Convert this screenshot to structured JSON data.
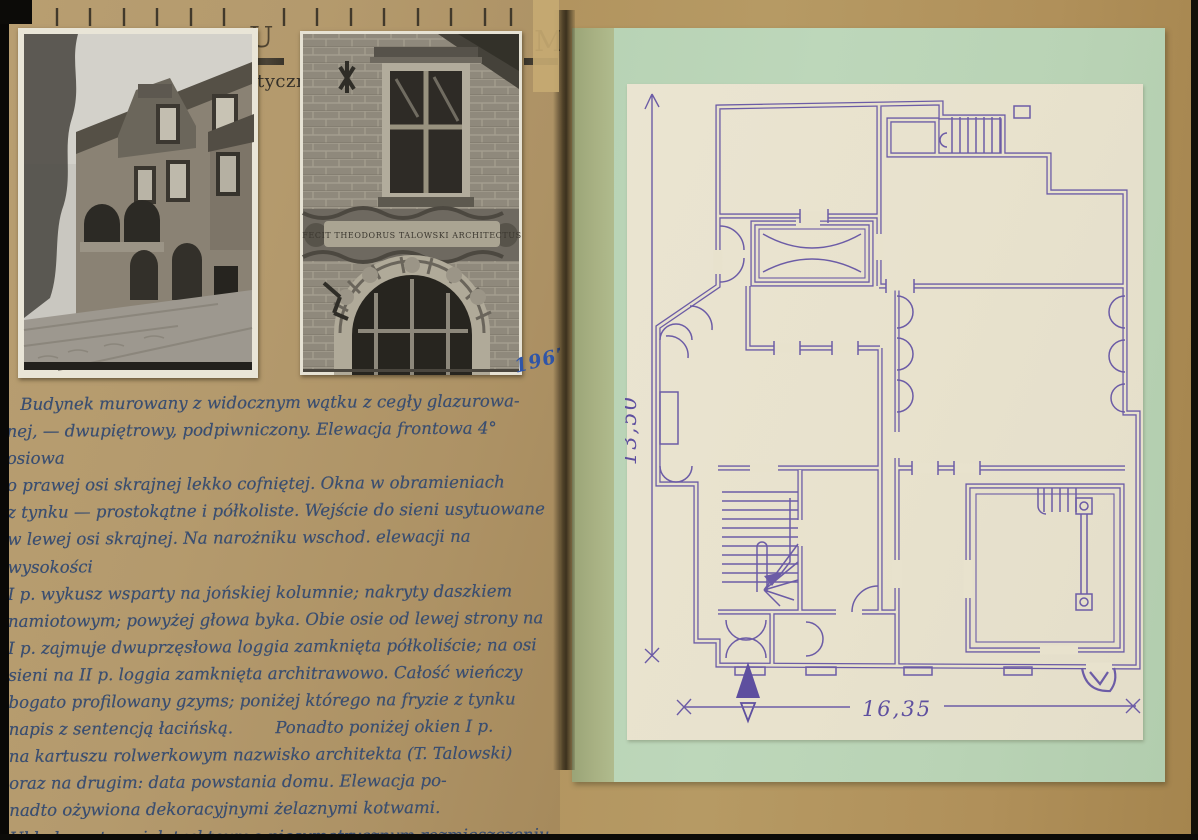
{
  "card": {
    "printed_letter_left": "U",
    "printed_letter_right": "M",
    "printed_fragment": "tyczn",
    "date_note": "1967"
  },
  "photos": {
    "plaque_text": "FECIT THEODORUS TALOWSKI ARCHITECTUS"
  },
  "handwriting": {
    "lines": [
      "Budynek murowany z widocznym wątku z cegły glazurowa-",
      "nej, — dwupiętrowy, podpiwniczony. Elewacja frontowa 4° osiowa",
      "o prawej osi skrajnej lekko cofniętej. Okna w obramieniach",
      "z tynku — prostokątne i półkoliste. Wejście do sieni usytuowane",
      "w lewej osi skrajnej. Na narożniku wschod. elewacji na wysokości",
      "I p. wykusz wsparty na jońskiej kolumnie; nakryty daszkiem",
      "namiotowym; powyżej głowa byka. Obie osie od lewej strony na",
      "I p. zajmuje dwuprzęsłowa loggia zamknięta półkoliście; na osi",
      "sieni na II p. loggia zamknięta architrawowo. Całość wieńczy",
      "bogato profilowany gzyms; poniżej którego na fryzie z tynku",
      "napis z sentencją łacińską.        Ponadto poniżej okien I p.",
      "na kartuszu rolwerkowym nazwisko architekta (T. Talowski)",
      "oraz na drugim: data powstania domu. Elewacja po-",
      "nadto ożywiona dekoracyjnymi żelaznymi kotwami.",
      "Układ wnętrz wielotraktowy o niesymetrycznym rozmieszczeniu",
      "pięter. pomieszczeń"
    ]
  },
  "plan": {
    "dim_vertical": "13,50",
    "dim_horizontal": "16,35"
  },
  "colors": {
    "card_tan": "#b49a6d",
    "green_sheet": "#bdd7ba",
    "cream_paper": "#e8e2cd",
    "plan_ink_violet": "#6c5ca6",
    "handwriting_ink": "#3a4e70",
    "date_ink_blue": "#2f55a8"
  }
}
